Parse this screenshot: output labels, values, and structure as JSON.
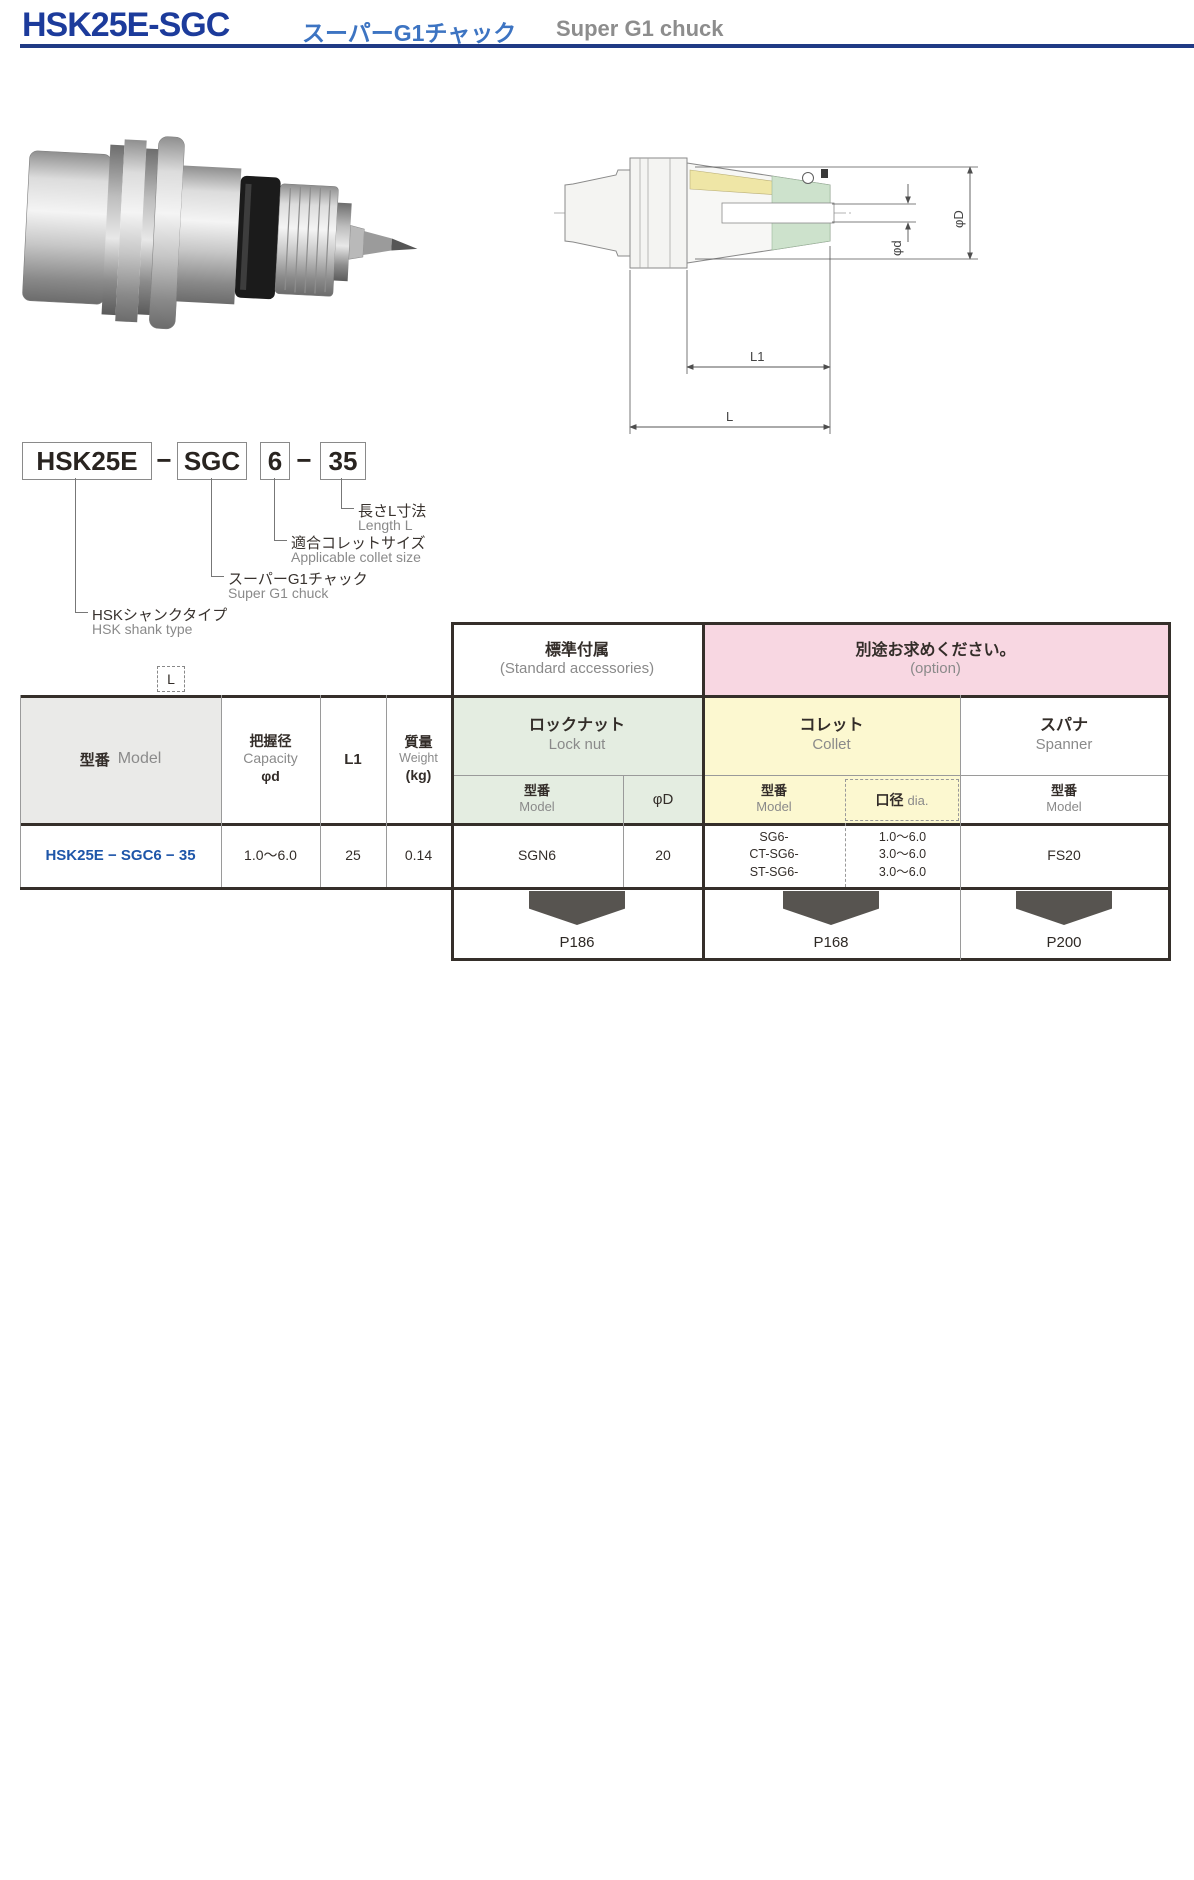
{
  "page": {
    "title_model": "HSK25E-SGC",
    "title_jp": "スーパーG1チャック",
    "title_en": "Super G1 chuck"
  },
  "model_code": {
    "boxes": [
      "HSK25E",
      "SGC",
      "6",
      "35"
    ],
    "dash": "−",
    "callouts": [
      {
        "jp": "長さL寸法",
        "en": "Length L"
      },
      {
        "jp": "適合コレットサイズ",
        "en": "Applicable collet size"
      },
      {
        "jp": "スーパーG1チャック",
        "en": "Super G1 chuck"
      },
      {
        "jp": "HSKシャンクタイプ",
        "en": "HSK shank type"
      }
    ]
  },
  "drawing": {
    "labels": {
      "phi_d": "φd",
      "phi_D": "φD",
      "l1": "L1",
      "l": "L"
    }
  },
  "table": {
    "legend_l": "L",
    "group_headers": {
      "standard": {
        "jp": "標準付属",
        "en": "(Standard accessories)"
      },
      "option": {
        "jp": "別途お求めください。",
        "en": "(option)"
      }
    },
    "columns": {
      "model": {
        "jp": "型番",
        "en": "Model"
      },
      "capacity": {
        "jp": "把握径",
        "en": "Capacity",
        "sub": "φd"
      },
      "l1": "L1",
      "weight": {
        "jp": "質量",
        "en": "Weight",
        "unit": "(kg)"
      },
      "locknut": {
        "jp": "ロックナット",
        "en": "Lock nut"
      },
      "collet": {
        "jp": "コレット",
        "en": "Collet"
      },
      "spanner": {
        "jp": "スパナ",
        "en": "Spanner"
      },
      "sub_model": {
        "jp": "型番",
        "en": "Model"
      },
      "phi_D": "φD",
      "dia": {
        "jp": "口径",
        "en": "dia."
      }
    },
    "row": {
      "model": "HSK25E − SGC6 − 35",
      "capacity": "1.0〜6.0",
      "l1": "25",
      "weight": "0.14",
      "locknut_model": "SGN6",
      "phi_D": "20",
      "collet_models": [
        "SG6-",
        "CT-SG6-",
        "ST-SG6-"
      ],
      "collet_dias": [
        "1.0〜6.0",
        "3.0〜6.0",
        "3.0〜6.0"
      ],
      "spanner_model": "FS20"
    },
    "page_refs": [
      "P186",
      "P168",
      "P200"
    ]
  },
  "colors": {
    "title_blue": "#1c3b9b",
    "subtitle_blue": "#3d74c2",
    "rule_navy": "#203a85",
    "model_row_blue": "#1e56a9",
    "option_pink": "#f8d7e2",
    "locknut_green": "#e4ede1",
    "collet_yellow": "#fcf8d0",
    "model_col_gray": "#eaeae8",
    "arrow_gray": "#575450"
  }
}
